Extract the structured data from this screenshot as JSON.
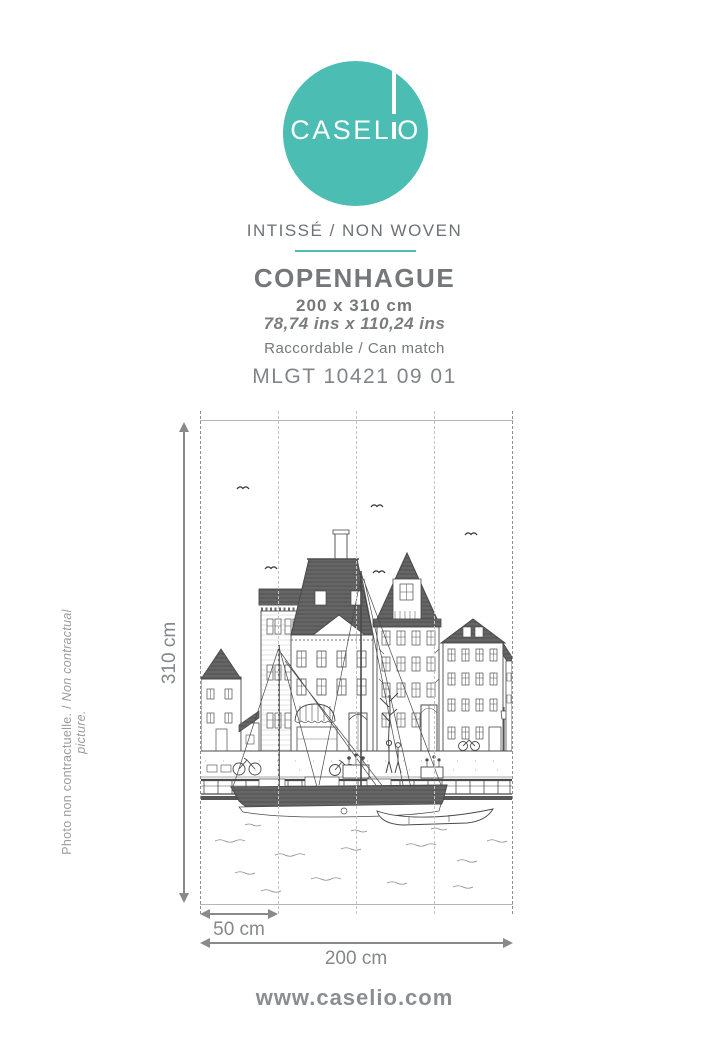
{
  "header": {
    "logo_left": "CASEL",
    "logo_right": "O",
    "material": "INTISSÉ / NON WOVEN",
    "product_name": "COPENHAGUE",
    "size_metric": "200 x 310 cm",
    "size_imperial": "78,74 ins x 110,24 ins",
    "match": "Raccordable / Can match",
    "reference": "MLGT 10421 09 01"
  },
  "diagram": {
    "height_label": "310 cm",
    "panel_label": "50 cm",
    "width_label": "200 cm",
    "panel_count": 4
  },
  "sidebar_note": {
    "fr": "Photo non contractuelle. /",
    "en": " Non contractual picture."
  },
  "footer": {
    "website": "www.caselio.com"
  },
  "colors": {
    "accent": "#4CBDB3",
    "text_gray": "#76797B",
    "dim_gray": "#8A8A8A"
  }
}
